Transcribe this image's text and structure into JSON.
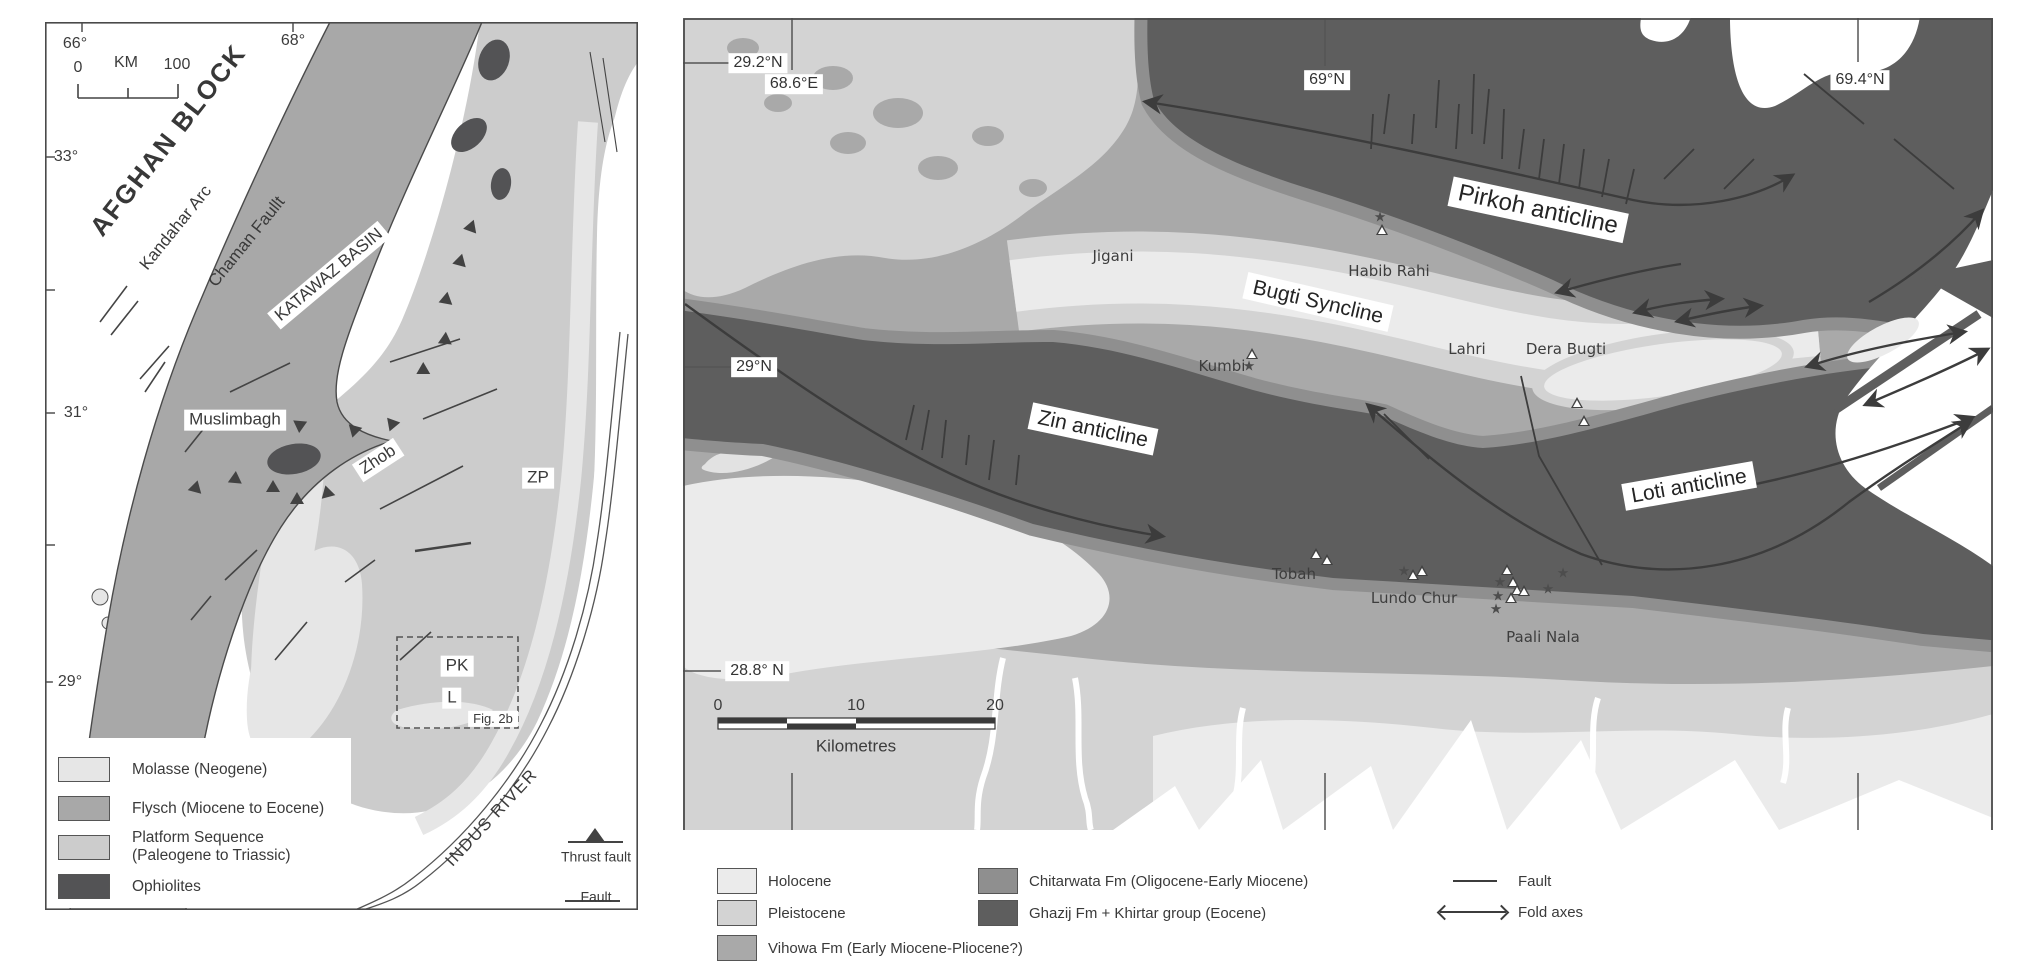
{
  "colors": {
    "holocene": "#ebebeb",
    "pleistocene": "#d3d3d3",
    "vihowa": "#a9a9a9",
    "chitarwata": "#8f8f8f",
    "ghazij": "#5e5e5e",
    "molasse": "#e6e6e6",
    "flysch": "#a8a8a8",
    "platform": "#cccccc",
    "ophiolite": "#535355",
    "line": "#3c3c3c",
    "frame": "#4a4a4a"
  },
  "left_panel": {
    "labels": [
      {
        "n": "lon-label-66",
        "t": "66°",
        "x": 75,
        "y": 44,
        "c": "tick"
      },
      {
        "n": "lon-label-68",
        "t": "68°",
        "x": 293,
        "y": 41,
        "c": "tick"
      },
      {
        "n": "km-scale-0",
        "t": "0",
        "x": 78,
        "y": 68,
        "c": "tick"
      },
      {
        "n": "km-scale-unit",
        "t": "KM",
        "x": 126,
        "y": 63,
        "c": "tick"
      },
      {
        "n": "km-scale-100",
        "t": "100",
        "x": 177,
        "y": 65,
        "c": "tick"
      },
      {
        "n": "lat-label-33",
        "t": "33°",
        "x": 66,
        "y": 157,
        "c": "tick"
      },
      {
        "n": "lat-label-31",
        "t": "31°",
        "x": 76,
        "y": 413,
        "c": "tick"
      },
      {
        "n": "lat-label-29",
        "t": "29°",
        "x": 70,
        "y": 682,
        "c": "tick boxed"
      },
      {
        "n": "afghan-block-label",
        "t": "AFGHAN BLOCK",
        "x": 168,
        "y": 140,
        "r": -52,
        "c": "big"
      },
      {
        "n": "kandahar-arc-label",
        "t": "Kandahar Arc",
        "x": 176,
        "y": 228,
        "r": -51,
        "c": "med"
      },
      {
        "n": "chaman-fault-label",
        "t": "Chaman Faullt",
        "x": 247,
        "y": 242,
        "r": -51,
        "c": "med"
      },
      {
        "n": "katawaz-basin-label",
        "t": "KATAWAZ BASIN",
        "x": 329,
        "y": 275,
        "r": -40,
        "c": "med boxed"
      },
      {
        "n": "muslimbagh-label",
        "t": "Muslimbagh",
        "x": 235,
        "y": 420,
        "c": "med boxed"
      },
      {
        "n": "zhob-label",
        "t": "Zhob",
        "x": 378,
        "y": 460,
        "r": -33,
        "c": "med boxed"
      },
      {
        "n": "zp-label",
        "t": "ZP",
        "x": 538,
        "y": 478,
        "c": "med boxed"
      },
      {
        "n": "pk-label",
        "t": "PK",
        "x": 457,
        "y": 666,
        "c": "med boxed"
      },
      {
        "n": "l-label",
        "t": "L",
        "x": 452,
        "y": 698,
        "c": "med boxed"
      },
      {
        "n": "fig-2b-label",
        "t": "Fig. 2b",
        "x": 493,
        "y": 719,
        "c": "small boxed"
      },
      {
        "n": "indus-river-label",
        "t": "INDUS RIVER",
        "x": 492,
        "y": 818,
        "r": -47,
        "c": "med sp"
      },
      {
        "n": "thrust-fault-legend-label",
        "t": "Thrust fault",
        "x": 596,
        "y": 857,
        "c": "sm"
      },
      {
        "n": "fault-legend-label",
        "t": "Fault",
        "x": 596,
        "y": 897,
        "c": "sm"
      }
    ],
    "legend": [
      {
        "label": "Molasse (Neogene)",
        "color": "molasse",
        "y": 757
      },
      {
        "label": "Flysch (Miocene to Eocene)",
        "color": "flysch",
        "y": 796
      },
      {
        "label": "Platform Sequence\n(Paleogene to Triassic)",
        "color": "platform",
        "y": 829
      },
      {
        "label": "Ophiolites",
        "color": "ophiolite",
        "y": 874
      }
    ]
  },
  "right_panel": {
    "labels": [
      {
        "n": "lat-label-29-2",
        "t": "29.2°N",
        "x": 758,
        "y": 63,
        "c": "coord"
      },
      {
        "n": "lon-label-68-6",
        "t": "68.6°E",
        "x": 794,
        "y": 84,
        "c": "coord"
      },
      {
        "n": "lon-label-69",
        "t": "69°N",
        "x": 1327,
        "y": 80,
        "c": "coord"
      },
      {
        "n": "lon-label-69-4",
        "t": "69.4°N",
        "x": 1860,
        "y": 80,
        "c": "coord"
      },
      {
        "n": "lat-label-29n",
        "t": "29°N",
        "x": 754,
        "y": 367,
        "c": "coord"
      },
      {
        "n": "lat-label-28-8",
        "t": "28.8° N",
        "x": 757,
        "y": 671,
        "c": "coord"
      },
      {
        "n": "pirkoh-anticline-label",
        "t": "Pirkoh anticline",
        "x": 1538,
        "y": 210,
        "r": 12,
        "c": "fold fold-lg"
      },
      {
        "n": "bugti-syncline-label",
        "t": "Bugti Syncline",
        "x": 1318,
        "y": 302,
        "r": 13,
        "c": "fold"
      },
      {
        "n": "zin-anticline-label",
        "t": "Zin anticline",
        "x": 1093,
        "y": 429,
        "r": 12,
        "c": "fold"
      },
      {
        "n": "loti-anticline-label",
        "t": "Loti anticline",
        "x": 1689,
        "y": 486,
        "r": -10,
        "c": "fold"
      },
      {
        "n": "place-jigani",
        "t": "Jigani",
        "x": 1113,
        "y": 256,
        "c": "place"
      },
      {
        "n": "place-habib-rahi",
        "t": "Habib Rahi",
        "x": 1389,
        "y": 271,
        "c": "place"
      },
      {
        "n": "place-kumbi",
        "t": "Kumbi",
        "x": 1222,
        "y": 366,
        "c": "place"
      },
      {
        "n": "place-lahri",
        "t": "Lahri",
        "x": 1467,
        "y": 349,
        "c": "place"
      },
      {
        "n": "place-dera-bugti",
        "t": "Dera Bugti",
        "x": 1566,
        "y": 349,
        "c": "place"
      },
      {
        "n": "place-tobah",
        "t": "Tobah",
        "x": 1294,
        "y": 574,
        "c": "place"
      },
      {
        "n": "place-lundo-chur",
        "t": "Lundo Chur",
        "x": 1414,
        "y": 598,
        "c": "place"
      },
      {
        "n": "place-paali-nala",
        "t": "Paali Nala",
        "x": 1543,
        "y": 637,
        "c": "place"
      },
      {
        "n": "scalebar-0",
        "t": "0",
        "x": 718,
        "y": 706,
        "c": "tick"
      },
      {
        "n": "scalebar-10",
        "t": "10",
        "x": 856,
        "y": 706,
        "c": "tick"
      },
      {
        "n": "scalebar-20",
        "t": "20",
        "x": 995,
        "y": 706,
        "c": "tick"
      },
      {
        "n": "scalebar-unit",
        "t": "Kilometres",
        "x": 856,
        "y": 747,
        "c": "med2"
      }
    ],
    "symbols": {
      "triangles": [
        [
          1382,
          232
        ],
        [
          1252,
          356
        ],
        [
          1577,
          405
        ],
        [
          1584,
          423
        ],
        [
          1316,
          556
        ],
        [
          1327,
          562
        ],
        [
          1413,
          577
        ],
        [
          1422,
          573
        ],
        [
          1507,
          572
        ],
        [
          1513,
          584
        ],
        [
          1517,
          592
        ],
        [
          1511,
          600
        ],
        [
          1524,
          593
        ]
      ],
      "stars": [
        [
          1380,
          218
        ],
        [
          1249,
          367
        ],
        [
          1404,
          572
        ],
        [
          1500,
          583
        ],
        [
          1498,
          597
        ],
        [
          1496,
          610
        ],
        [
          1548,
          590
        ],
        [
          1563,
          574
        ]
      ]
    }
  },
  "legend": {
    "items": [
      {
        "label": "Holocene",
        "color": "holocene",
        "x": 717,
        "y": 868
      },
      {
        "label": "Pleistocene",
        "color": "pleistocene",
        "x": 717,
        "y": 900
      },
      {
        "label": "Vihowa Fm (Early Miocene-Pliocene?)",
        "color": "vihowa",
        "x": 717,
        "y": 935
      },
      {
        "label": "Chitarwata Fm (Oligocene-Early Miocene)",
        "color": "chitarwata",
        "x": 978,
        "y": 868
      },
      {
        "label": "Ghazij Fm + Khirtar group (Eocene)",
        "color": "ghazij",
        "x": 978,
        "y": 900
      }
    ],
    "symbols": [
      {
        "type": "fault",
        "label": "Fault",
        "x": 1453,
        "y": 872,
        "gap": 21
      },
      {
        "type": "fold",
        "label": "Fold axes",
        "x": 1440,
        "y": 903,
        "gap": 12
      }
    ]
  }
}
